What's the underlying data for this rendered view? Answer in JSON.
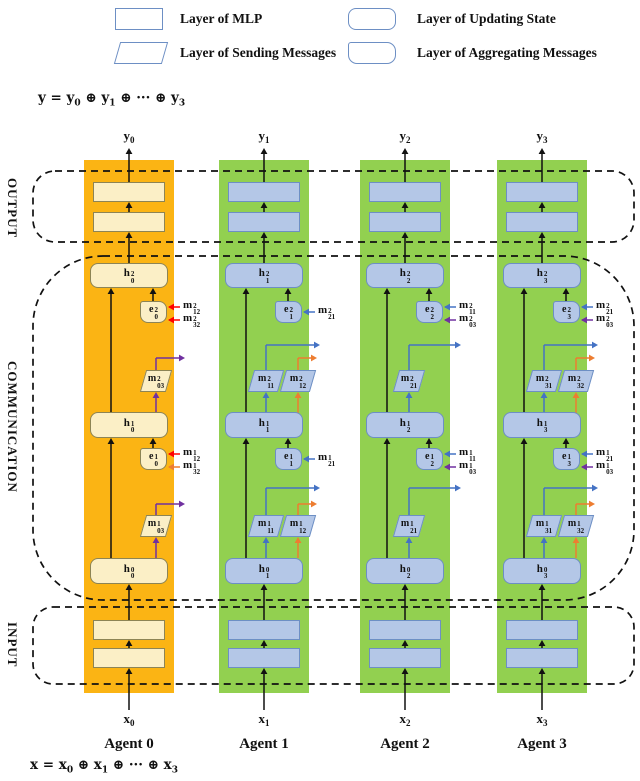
{
  "legend": [
    {
      "shape": "mlp",
      "label": "Layer of MLP"
    },
    {
      "shape": "update",
      "label": "Layer of Updating State"
    },
    {
      "shape": "send",
      "label": "Layer of Sending Messages"
    },
    {
      "shape": "aggregate",
      "label": "Layer of Aggregating Messages"
    }
  ],
  "formulas": {
    "top": "y = y_0 ⊕ y_1 ⊕ ··· ⊕ y_3",
    "bottom": "x = x_0 ⊕ x_1 ⊕ ··· ⊕ x_3"
  },
  "regions": [
    {
      "label": "OUTPUT"
    },
    {
      "label": "COMMUNICATION"
    },
    {
      "label": "INPUT"
    }
  ],
  "colors": {
    "agent0_column": "#FBB414",
    "green_column": "#92D050",
    "yellow_fill": "#FBEFC6",
    "yellow_border": "#8C8455",
    "blue_fill": "#B4C7E7",
    "blue_border": "#6D8FC4",
    "black": "#111111",
    "blue": "#4472C4",
    "purple": "#7030A0",
    "orange": "#ED7D31",
    "red": "#FF0000"
  },
  "agents": [
    {
      "name": "Agent 0",
      "input": {
        "base": "x",
        "sub": "0"
      },
      "output": {
        "base": "y",
        "sub": "0"
      },
      "strip": "agent0_column",
      "fill": "yellow_fill",
      "border": "yellow_border",
      "h2": {
        "base": "h",
        "sup": "2",
        "sub": "0"
      },
      "h1": {
        "base": "h",
        "sup": "1",
        "sub": "0"
      },
      "h0": {
        "base": "h",
        "sup": "0",
        "sub": "0"
      },
      "e2": {
        "base": "e",
        "sup": "2",
        "sub": "0"
      },
      "e1": {
        "base": "e",
        "sup": "1",
        "sub": "0"
      },
      "out2": [
        {
          "base": "m",
          "sup": "2",
          "sub": "03",
          "color": "purple"
        }
      ],
      "out1": [
        {
          "base": "m",
          "sup": "1",
          "sub": "03",
          "color": "purple"
        }
      ],
      "in2": [
        {
          "base": "m",
          "sup": "2",
          "sub": "12",
          "color": "red"
        },
        {
          "base": "m",
          "sup": "2",
          "sub": "32",
          "color": "red"
        }
      ],
      "in1": [
        {
          "base": "m",
          "sup": "1",
          "sub": "12",
          "color": "red"
        },
        {
          "base": "m",
          "sup": "1",
          "sub": "32",
          "color": "orange"
        }
      ]
    },
    {
      "name": "Agent 1",
      "input": {
        "base": "x",
        "sub": "1"
      },
      "output": {
        "base": "y",
        "sub": "1"
      },
      "strip": "green_column",
      "fill": "blue_fill",
      "border": "blue_border",
      "h2": {
        "base": "h",
        "sup": "2",
        "sub": "1"
      },
      "h1": {
        "base": "h",
        "sup": "1",
        "sub": "1"
      },
      "h0": {
        "base": "h",
        "sup": "0",
        "sub": "1"
      },
      "e2": {
        "base": "e",
        "sup": "2",
        "sub": "1"
      },
      "e1": {
        "base": "e",
        "sup": "1",
        "sub": "1"
      },
      "out2": [
        {
          "base": "m",
          "sup": "2",
          "sub": "11",
          "color": "blue"
        },
        {
          "base": "m",
          "sup": "2",
          "sub": "12",
          "color": "orange"
        }
      ],
      "out1": [
        {
          "base": "m",
          "sup": "1",
          "sub": "11",
          "color": "blue"
        },
        {
          "base": "m",
          "sup": "1",
          "sub": "12",
          "color": "orange"
        }
      ],
      "in2": [
        {
          "base": "m",
          "sup": "2",
          "sub": "21",
          "color": "blue"
        }
      ],
      "in1": [
        {
          "base": "m",
          "sup": "1",
          "sub": "21",
          "color": "blue"
        }
      ]
    },
    {
      "name": "Agent 2",
      "input": {
        "base": "x",
        "sub": "2"
      },
      "output": {
        "base": "y",
        "sub": "2"
      },
      "strip": "green_column",
      "fill": "blue_fill",
      "border": "blue_border",
      "h2": {
        "base": "h",
        "sup": "2",
        "sub": "2"
      },
      "h1": {
        "base": "h",
        "sup": "1",
        "sub": "2"
      },
      "h0": {
        "base": "h",
        "sup": "0",
        "sub": "2"
      },
      "e2": {
        "base": "e",
        "sup": "2",
        "sub": "2"
      },
      "e1": {
        "base": "e",
        "sup": "1",
        "sub": "2"
      },
      "out2": [
        {
          "base": "m",
          "sup": "2",
          "sub": "21",
          "color": "blue"
        }
      ],
      "out1": [
        {
          "base": "m",
          "sup": "1",
          "sub": "21",
          "color": "blue"
        }
      ],
      "in2": [
        {
          "base": "m",
          "sup": "2",
          "sub": "11",
          "color": "blue"
        },
        {
          "base": "m",
          "sup": "2",
          "sub": "03",
          "color": "purple"
        }
      ],
      "in1": [
        {
          "base": "m",
          "sup": "1",
          "sub": "11",
          "color": "blue"
        },
        {
          "base": "m",
          "sup": "1",
          "sub": "03",
          "color": "purple"
        }
      ]
    },
    {
      "name": "Agent 3",
      "input": {
        "base": "x",
        "sub": "3"
      },
      "output": {
        "base": "y",
        "sub": "3"
      },
      "strip": "green_column",
      "fill": "blue_fill",
      "border": "blue_border",
      "h2": {
        "base": "h",
        "sup": "2",
        "sub": "3"
      },
      "h1": {
        "base": "h",
        "sup": "1",
        "sub": "3"
      },
      "h0": {
        "base": "h",
        "sup": "0",
        "sub": "3"
      },
      "e2": {
        "base": "e",
        "sup": "2",
        "sub": "3"
      },
      "e1": {
        "base": "e",
        "sup": "1",
        "sub": "3"
      },
      "out2": [
        {
          "base": "m",
          "sup": "2",
          "sub": "31",
          "color": "blue"
        },
        {
          "base": "m",
          "sup": "2",
          "sub": "32",
          "color": "orange"
        }
      ],
      "out1": [
        {
          "base": "m",
          "sup": "1",
          "sub": "31",
          "color": "blue"
        },
        {
          "base": "m",
          "sup": "1",
          "sub": "32",
          "color": "orange"
        }
      ],
      "in2": [
        {
          "base": "m",
          "sup": "2",
          "sub": "21",
          "color": "blue"
        },
        {
          "base": "m",
          "sup": "2",
          "sub": "03",
          "color": "purple"
        }
      ],
      "in1": [
        {
          "base": "m",
          "sup": "1",
          "sub": "21",
          "color": "blue"
        },
        {
          "base": "m",
          "sup": "1",
          "sub": "03",
          "color": "purple"
        }
      ]
    }
  ]
}
